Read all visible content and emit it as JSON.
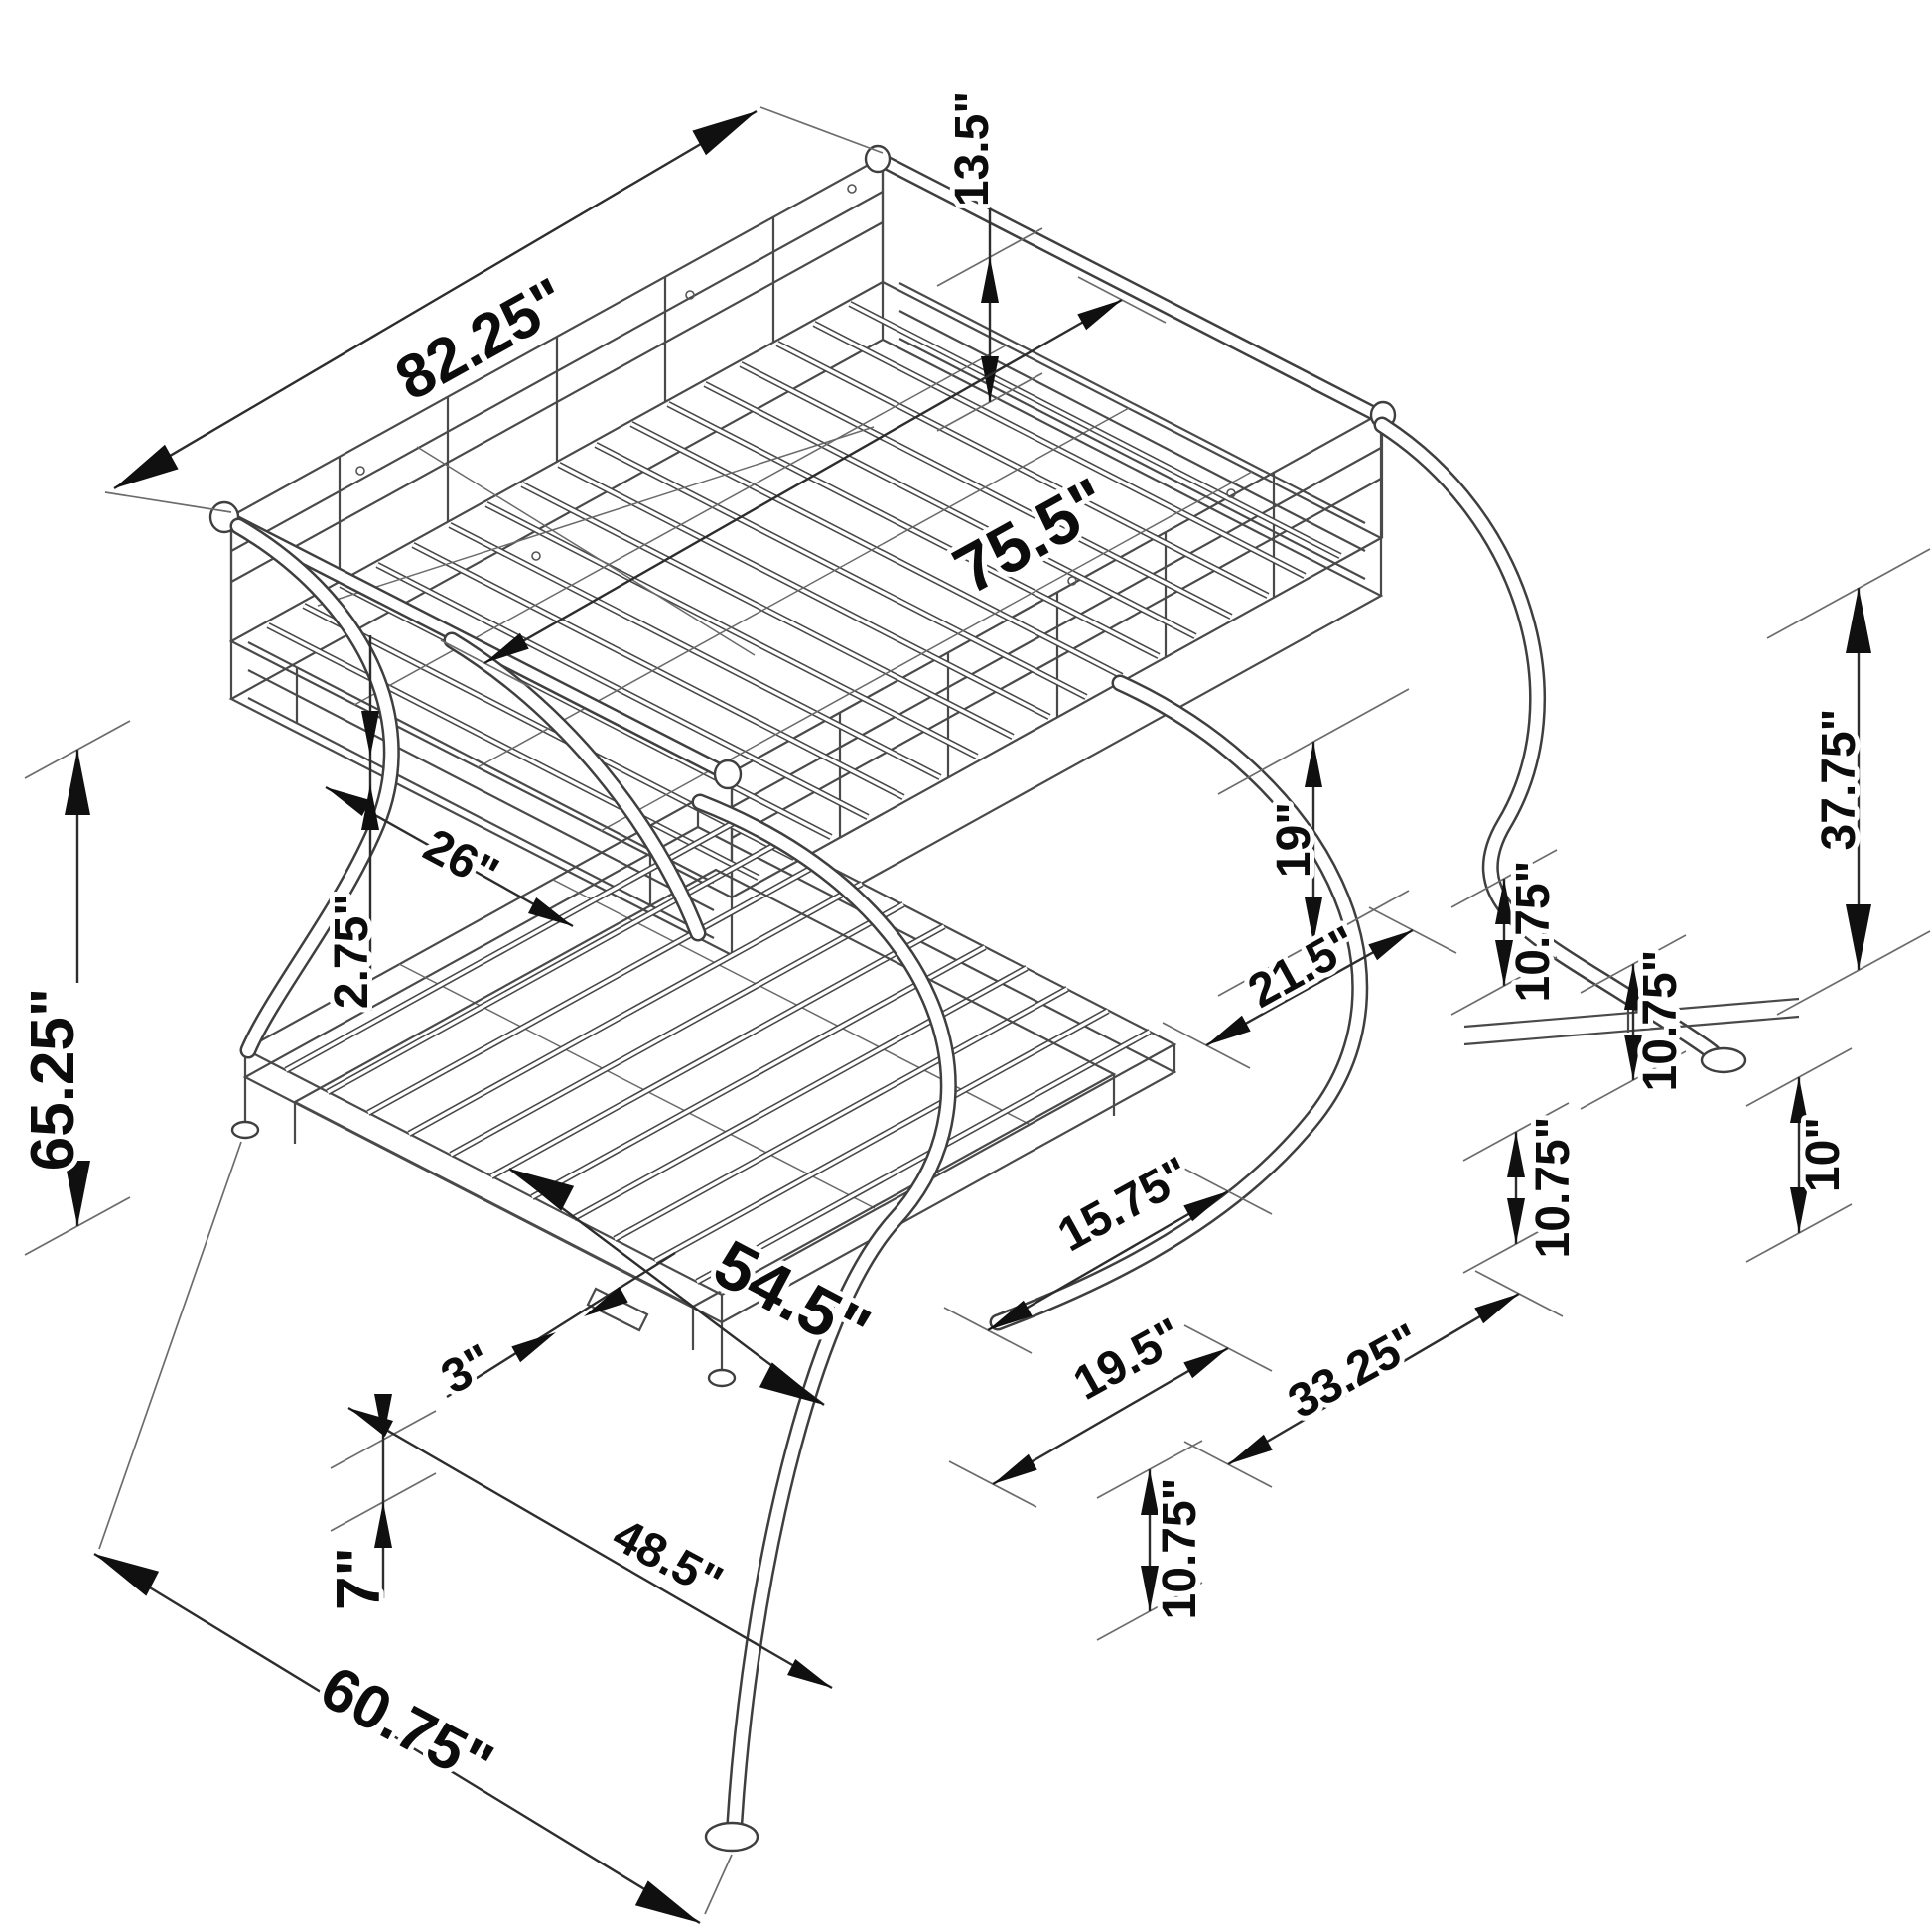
{
  "diagram": {
    "type": "isometric-technical-drawing",
    "subject": "bunk bed with futon base and trundle, C-shaped tubular legs",
    "unit": "inches",
    "colors": {
      "background": "#ffffff",
      "structure_line": "#4a4a4a",
      "dimension_line": "#2d2d2d",
      "arrow": "#101010",
      "label_text": "#0c0c0c"
    },
    "labels": {
      "rail_to_deck_height": "13.5\"",
      "overall_length": "82.25\"",
      "sleep_surface_length": "75.5\"",
      "headboard_panel_length": "26\"",
      "rail_gap": "2.75\"",
      "overall_height": "65.25\"",
      "bunk_clearance": "19\"",
      "under_deck_clearance": "37.75\"",
      "leg_offset_upper_a": "10.75\"",
      "leg_offset_upper_b": "10.75\"",
      "leg_span_upper": "21.5\"",
      "leg_offset_lower": "10.75\"",
      "shelf_height": "10\"",
      "front_leg_span": "15.75\"",
      "futon_width": "54.5\"",
      "slat_spacing": "3\"",
      "rear_leg_span": "19.5\"",
      "base_section_length": "33.25\"",
      "base_deck_height": "10.75\"",
      "trundle_height": "7\"",
      "trundle_width": "48.5\"",
      "overall_width": "60.75\""
    }
  }
}
